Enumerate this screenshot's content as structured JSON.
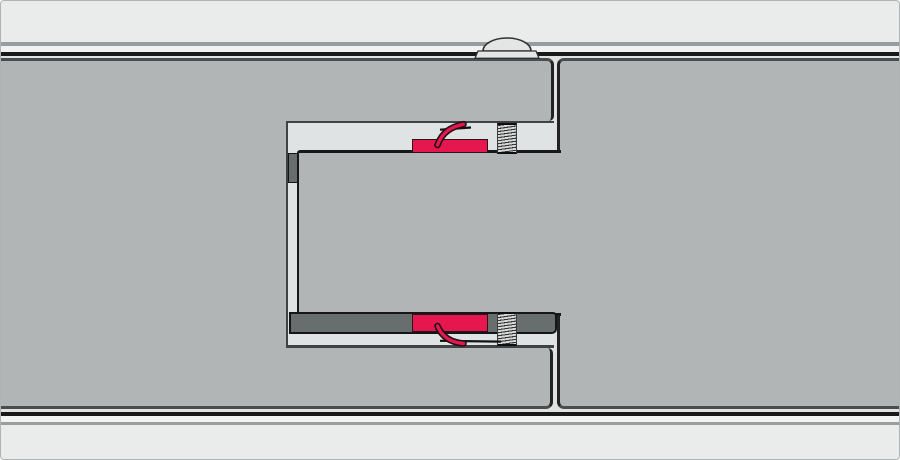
{
  "diagram": {
    "kind": "technical cross-section illustration",
    "subject": "tongue-and-groove sandwich panel joint with cam locks",
    "components": [
      "left-panel",
      "right-panel",
      "panel-tongue",
      "joint-pocket",
      "top-cam-lock",
      "bottom-cam-lock",
      "top-cam-hook",
      "bottom-cam-hook",
      "top-locking-pin",
      "bottom-locking-pin",
      "top-corner-seal",
      "bottom-gasket-seal",
      "exterior-skin-line",
      "interior-skin-line",
      "cover-cap-dome",
      "joint-slit"
    ]
  },
  "colors": {
    "canvas_bg": "#eaebeb",
    "frame_line": "#b0b3b3",
    "band_gray": "#9a9d9d",
    "band_light": "#f1f2f2",
    "skin_black": "#191919",
    "sliver": "#e0e2e2",
    "panel_gray": "#b1b5b6",
    "panel_face_line": "#4a4d4d",
    "panel_edge_line": "#202223",
    "pocket_fill": "#e0e3e3",
    "pocket_line": "#3f4343",
    "tongue_line": "#161819",
    "seal_fill": "#686d6e",
    "seal_line": "#141617",
    "pin_stroke": "#333333",
    "pin_bg": "#d6d8d8",
    "cam_red": "#e6164e",
    "cam_outline": "#2a1419",
    "hook_red": "#e6164e",
    "hook_outline": "#1c1114",
    "tick_black": "#111111",
    "dome_fill": "#e4e6e6",
    "dome_line": "#2f3233"
  }
}
